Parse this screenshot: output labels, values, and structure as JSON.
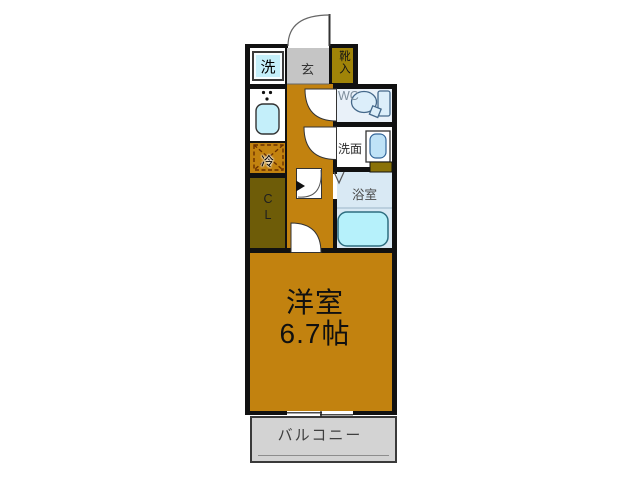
{
  "labels": {
    "washer": "洗",
    "entrance": "玄",
    "shoe_storage": "靴入",
    "wc": "WC",
    "washstand": "洗面",
    "bathroom": "浴室",
    "refrigerator": "冷",
    "closet": "CL",
    "room_name": "洋室",
    "room_size": "6.7帖",
    "balcony": "バルコニー"
  },
  "colors": {
    "wall": "#111111",
    "ochre": "#C2820F",
    "olive-dark": "#6E5C08",
    "olive-light": "#A08408",
    "genkan": "#C5C5C5",
    "balcony": "#D3D3D3",
    "wc-bg": "#E9F1F9",
    "bath-bg": "#D9E9F4",
    "fixture-blue": "#C4EFFA",
    "tub-blue": "#B6F1FB"
  }
}
